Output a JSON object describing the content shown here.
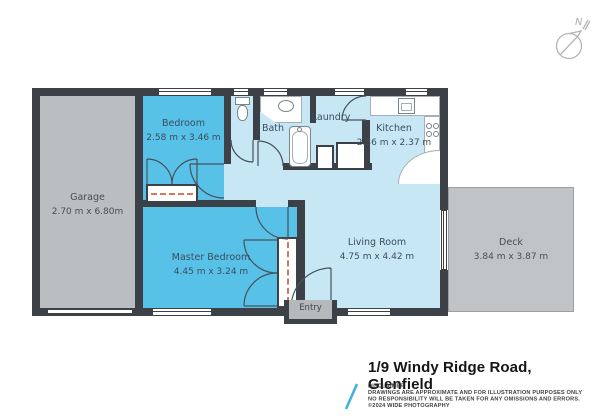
{
  "compass": {
    "north_label": "N"
  },
  "rooms": {
    "garage": {
      "name": "Garage",
      "dims": "2.70 m x 6.80m"
    },
    "bedroom": {
      "name": "Bedroom",
      "dims": "2.58 m x 3.46 m"
    },
    "bath": {
      "name": "Bath",
      "dims": ""
    },
    "laundry": {
      "name": "Laundry",
      "dims": ""
    },
    "kitchen": {
      "name": "Kitchen",
      "dims": "2.36 m x 2.37 m"
    },
    "master_bedroom": {
      "name": "Master Bedroom",
      "dims": "4.45 m x 3.24 m"
    },
    "living_room": {
      "name": "Living Room",
      "dims": "4.75 m x 4.42 m"
    },
    "deck": {
      "name": "Deck",
      "dims": "3.84 m x 3.87 m"
    },
    "entry": {
      "name": "Entry",
      "dims": ""
    }
  },
  "footer": {
    "title": "1/9 Windy Ridge Road, Glenfield",
    "disclaimer": [
      "DISCLAIMER",
      "DRAWINGS ARE APPROXIMATE AND FOR ILLUSTRATION PURPOSES ONLY",
      "NO RESPONSIBILITY WILL BE TAKEN FOR ANY OMISSIONS AND ERRORS.",
      "©2024 WIDE PHOTOGRAPHY"
    ]
  },
  "colors": {
    "wall": "#3b4147",
    "bedroom_blue": "#58c1e8",
    "floor_light_blue": "#c8e7f5",
    "garage_gray": "#babec1",
    "deck_gray": "#c1c4c7",
    "accent_slash_blue": "#45b1e0"
  }
}
